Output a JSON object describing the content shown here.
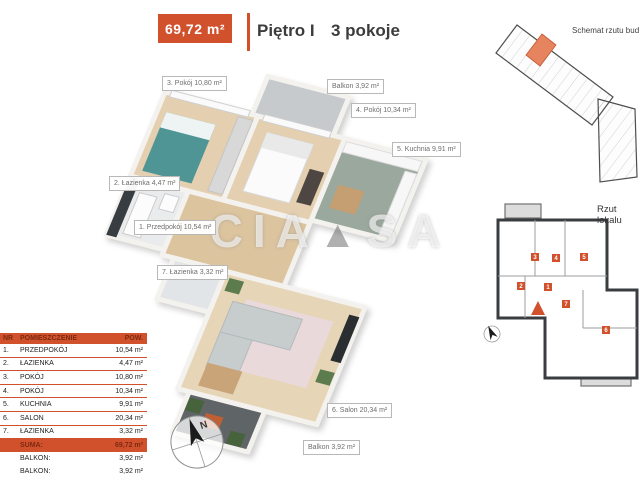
{
  "header": {
    "area_label": "69,72 m²",
    "floor_label": "Piętro I",
    "rooms_label": "3 pokoje"
  },
  "colors": {
    "accent": "#d2512d",
    "highlight_unit": "#e5845e"
  },
  "watermark": {
    "left": "CIA",
    "triangle": "▲",
    "right": "SA"
  },
  "plan_labels": [
    {
      "id": "pokoj3",
      "text": "3. Pokój 10,80 m²"
    },
    {
      "id": "balkon-gora",
      "text": "Balkon 3,92 m²"
    },
    {
      "id": "pokoj4",
      "text": "4. Pokój 10,34 m²"
    },
    {
      "id": "kuchnia",
      "text": "5. Kuchnia 9,91 m²"
    },
    {
      "id": "lazienka2",
      "text": "2. Łazienka 4,47 m²"
    },
    {
      "id": "przedpokoj",
      "text": "1. Przedpokój 10,54 m²"
    },
    {
      "id": "lazienka7",
      "text": "7. Łazienka 3,32 m²"
    },
    {
      "id": "salon",
      "text": "6. Salon 20,34 m²"
    },
    {
      "id": "balkon-dol",
      "text": "Balkon 3,92 m²"
    }
  ],
  "table": {
    "headers": {
      "nr": "NR",
      "name": "POMIESZCZENIE",
      "pow": "POW."
    },
    "rows": [
      {
        "nr": "1.",
        "name": "PRZEDPOKÓJ",
        "area": "10,54 m²"
      },
      {
        "nr": "2.",
        "name": "ŁAZIENKA",
        "area": "4,47 m²"
      },
      {
        "nr": "3.",
        "name": "POKÓJ",
        "area": "10,80 m²"
      },
      {
        "nr": "4.",
        "name": "POKÓJ",
        "area": "10,34 m²"
      },
      {
        "nr": "5.",
        "name": "KUCHNIA",
        "area": "9,91 m²"
      },
      {
        "nr": "6.",
        "name": "SALON",
        "area": "20,34 m²"
      },
      {
        "nr": "7.",
        "name": "ŁAZIENKA",
        "area": "3,32 m²"
      }
    ],
    "suma": {
      "label": "SUMA:",
      "area": "69,72 m²"
    },
    "balkony": [
      {
        "label": "BALKON:",
        "area": "3,92 m²"
      },
      {
        "label": "BALKON:",
        "area": "3,92 m²"
      }
    ]
  },
  "side": {
    "schemat_title": "Schemat rzutu bud",
    "rzut_title": "Rzut lokalu"
  },
  "compass": {
    "label": "N"
  },
  "mini_plan": {
    "markers": [
      "3",
      "4",
      "5",
      "2",
      "1",
      "7",
      "6"
    ]
  }
}
